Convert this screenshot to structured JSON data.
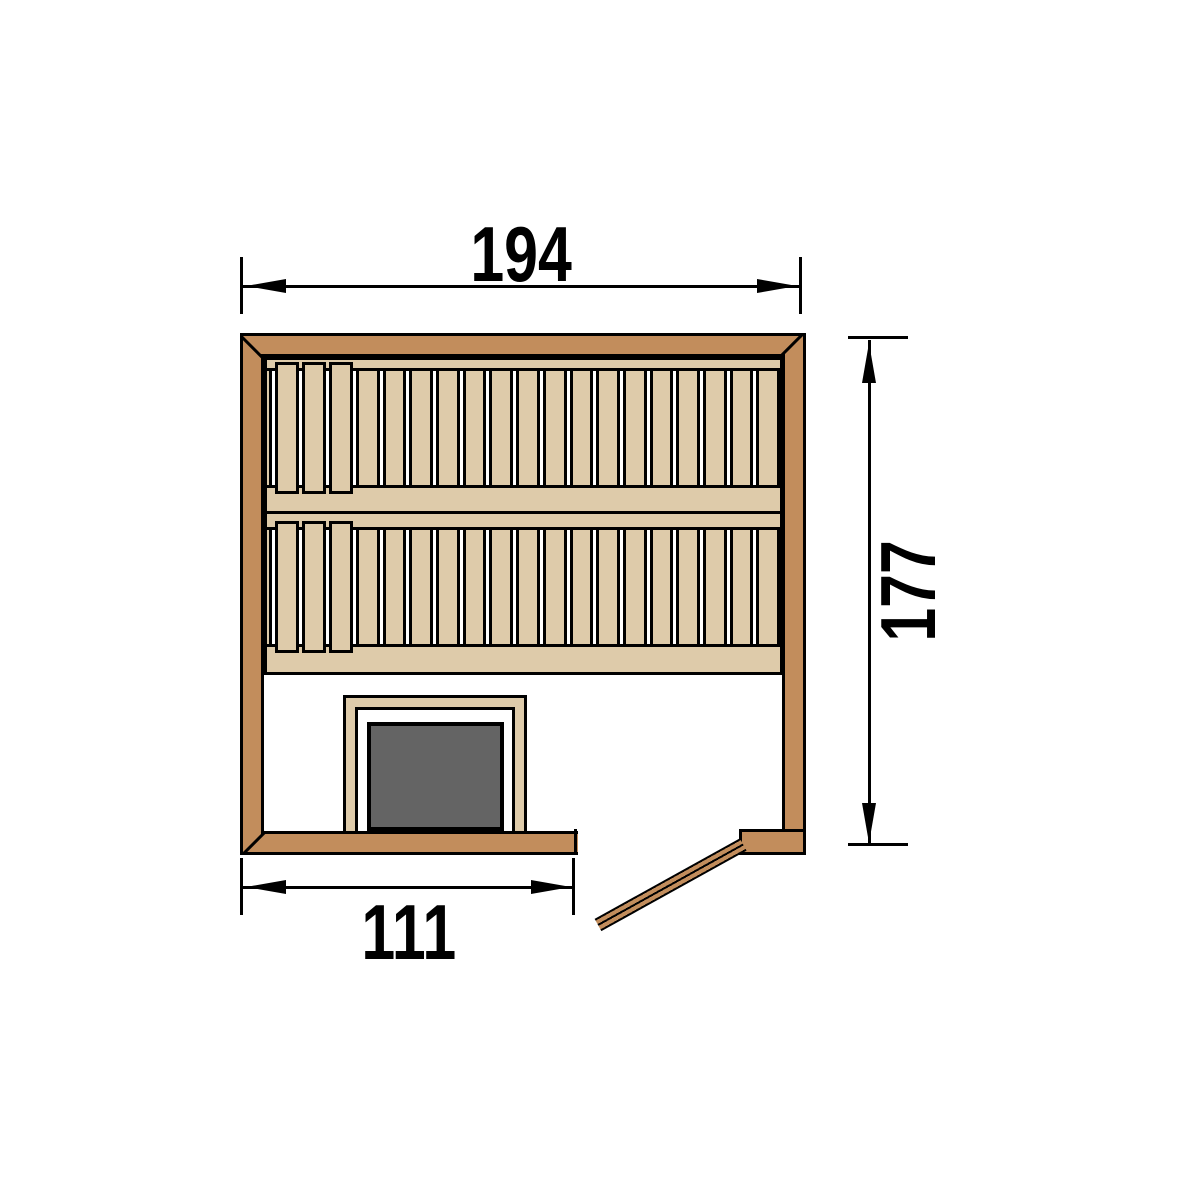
{
  "diagram": {
    "type": "sauna-floor-plan-top-view",
    "dimension_labels": {
      "width": "194",
      "depth": "177",
      "front": "111"
    },
    "colors": {
      "wall": "#c28d5c",
      "wood": "#decbaa",
      "heater": "#646464",
      "line": "#000000",
      "background": "#ffffff"
    },
    "benches": [
      {
        "name": "upper-bench",
        "wide_slats": 3,
        "slats": 16
      },
      {
        "name": "lower-bench",
        "wide_slats": 3,
        "slats": 16
      }
    ]
  }
}
